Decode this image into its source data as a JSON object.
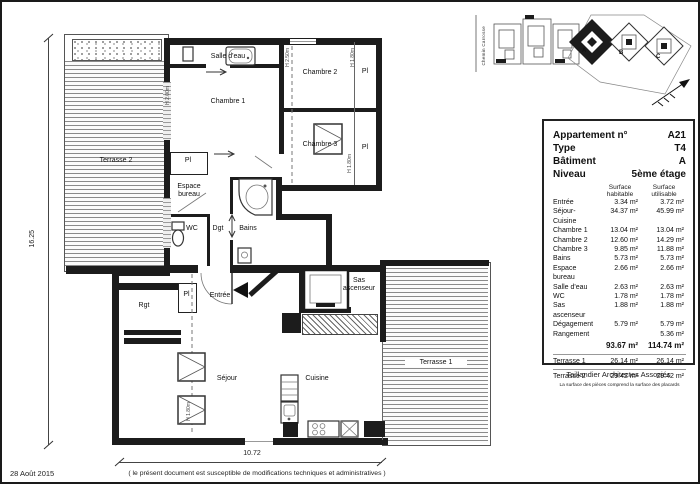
{
  "meta": {
    "date": "28 Août 2015",
    "disclaimer": "( le présent document est susceptible de modifications techniques et administratives )"
  },
  "plan": {
    "labels": {
      "terrasse1": "Terrasse 1",
      "terrasse2": "Terrasse 2",
      "salle_eau": "Salle d'eau",
      "chambre1": "Chambre 1",
      "chambre2": "Chambre 2",
      "chambre3": "Chambre 3",
      "espace_bureau_l1": "Espace",
      "espace_bureau_l2": "bureau",
      "wc": "WC",
      "dgt": "Dgt",
      "bains": "Bains",
      "entree": "Entrée",
      "rgt": "Rgt",
      "sejour": "Séjour",
      "cuisine": "Cuisine",
      "sas_l1": "Sas",
      "sas_l2": "ascenseur",
      "pl": "Pl"
    },
    "dimensions": {
      "width": "10.72",
      "height": "16.25"
    },
    "height_marks": {
      "m1": "H 2.00m",
      "m2": "H 2.50m",
      "m3": "H 1.80m",
      "m4": "H 1.80m",
      "m5": "H 1.80m"
    }
  },
  "site_plan": {
    "street": "Chemin Carrosse",
    "buildings": [
      "A",
      "B",
      "C"
    ]
  },
  "info_table": {
    "rows_header": [
      {
        "label": "Appartement n°",
        "value": "A21"
      },
      {
        "label": "Type",
        "value": "T4"
      },
      {
        "label": "Bâtiment",
        "value": "A"
      },
      {
        "label": "Niveau",
        "value": "5ème étage"
      }
    ],
    "col_habitable": "Surface habitable",
    "col_utilisable": "Surface utilisable",
    "rows": [
      {
        "label": "Entrée",
        "habitable": "3.34 m²",
        "utilisable": "3.72 m²"
      },
      {
        "label": "Séjour-Cuisine",
        "habitable": "34.37 m²",
        "utilisable": "45.99 m²"
      },
      {
        "label": "Chambre 1",
        "habitable": "13.04 m²",
        "utilisable": "13.04 m²"
      },
      {
        "label": "Chambre 2",
        "habitable": "12.60 m²",
        "utilisable": "14.29 m²"
      },
      {
        "label": "Chambre 3",
        "habitable": "9.85 m²",
        "utilisable": "11.88 m²"
      },
      {
        "label": "Bains",
        "habitable": "5.73 m²",
        "utilisable": "5.73 m²"
      },
      {
        "label": "Espace bureau",
        "habitable": "2.66 m²",
        "utilisable": "2.66 m²"
      },
      {
        "label": "Salle d'eau",
        "habitable": "2.63 m²",
        "utilisable": "2.63 m²"
      },
      {
        "label": "WC",
        "habitable": "1.78 m²",
        "utilisable": "1.78 m²"
      },
      {
        "label": "Sas ascenseur",
        "habitable": "1.88 m²",
        "utilisable": "1.88 m²"
      },
      {
        "label": "Dégagement",
        "habitable": "5.79 m²",
        "utilisable": "5.79 m²"
      },
      {
        "label": "Rangement",
        "habitable": "",
        "utilisable": "5.36 m²"
      }
    ],
    "total": {
      "habitable": "93.67 m²",
      "utilisable": "114.74 m²"
    },
    "terrasse_rows": [
      {
        "label": "Terrasse 1",
        "habitable": "26.14 m²",
        "utilisable": "26.14 m²"
      },
      {
        "label": "Terrasse 2",
        "habitable": "29.42 m²",
        "utilisable": "29.42 m²"
      }
    ],
    "footnote": "La surface des pièces comprend la surface des placards",
    "firm": "Taillandier Architectes Associés"
  }
}
